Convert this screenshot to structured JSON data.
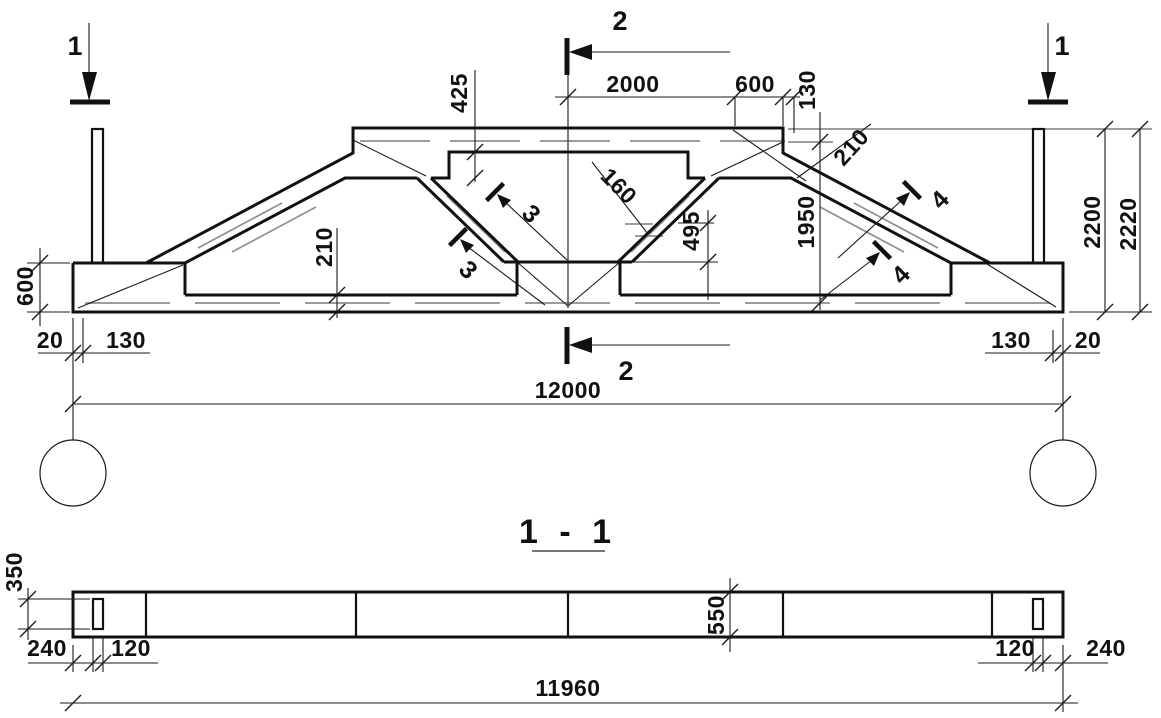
{
  "drawing": {
    "marks": {
      "cut1": "1",
      "cut2": "2",
      "detail3": "3",
      "detail4": "4"
    },
    "elevation": {
      "dims": {
        "top_2000": "2000",
        "top_600": "600",
        "top_130": "130",
        "chord_depth_425": "425",
        "web_160": "160",
        "web_495": "495",
        "height_1950": "1950",
        "diag_210": "210",
        "bottom_chord_210": "210",
        "end_600": "600",
        "left_20": "20",
        "left_130": "130",
        "right_130": "130",
        "right_20": "20",
        "span_12000": "12000",
        "height_2200": "2200",
        "height_2220": "2220"
      }
    },
    "section": {
      "title": "1 - 1",
      "dims": {
        "d350": "350",
        "left_240": "240",
        "left_120": "120",
        "depth_550": "550",
        "right_120": "120",
        "right_240": "240",
        "length_11960": "11960"
      }
    }
  }
}
